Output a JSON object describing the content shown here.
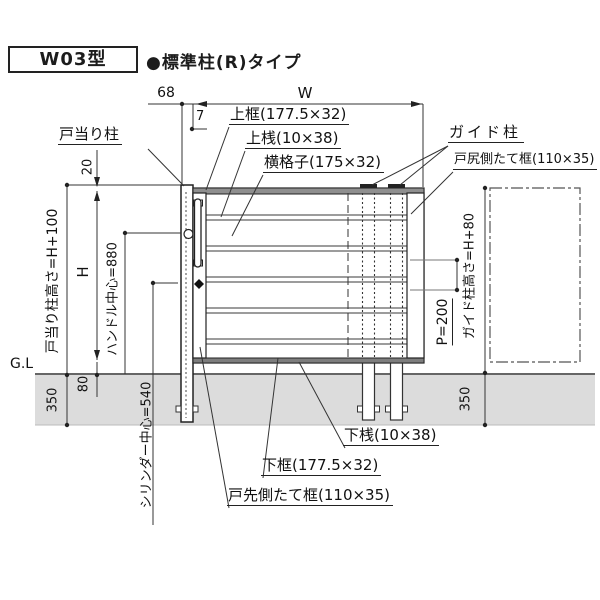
{
  "title": {
    "model": "W03型",
    "type": "●標準柱(R)タイプ"
  },
  "top_dims": {
    "offset": "68",
    "width": "W",
    "gap": "7"
  },
  "part_labels": {
    "door_stop_post": "戸当り柱",
    "top_frame": "上框(177.5×32)",
    "top_rail": "上桟(10×38)",
    "lattice": "横格子(175×32)",
    "guide_post": "ガイド柱",
    "rear_stile": "戸尻側たて框(110×35)",
    "bottom_rail": "下桟(10×38)",
    "bottom_frame": "下框(177.5×32)",
    "front_stile": "戸先側たて框(110×35)"
  },
  "left_dims": {
    "post_height": "戸当り柱高さ=H+100",
    "top_offset": "20",
    "height": "H",
    "handle_center": "ハンドル中心=880",
    "ground_line": "G.L",
    "bottom_gap": "80",
    "embed_depth": "350",
    "cylinder_center": "シリンダー中心=540"
  },
  "right_dims": {
    "guide_post_height": "ガイド柱高さ=H+80",
    "pitch": "P=200",
    "embed_depth": "350"
  },
  "colors": {
    "line": "#2b2b2b",
    "frame_fill": "#8f8f8f",
    "ground_fill": "#dcdcdc",
    "phantom_line": "#555555"
  }
}
